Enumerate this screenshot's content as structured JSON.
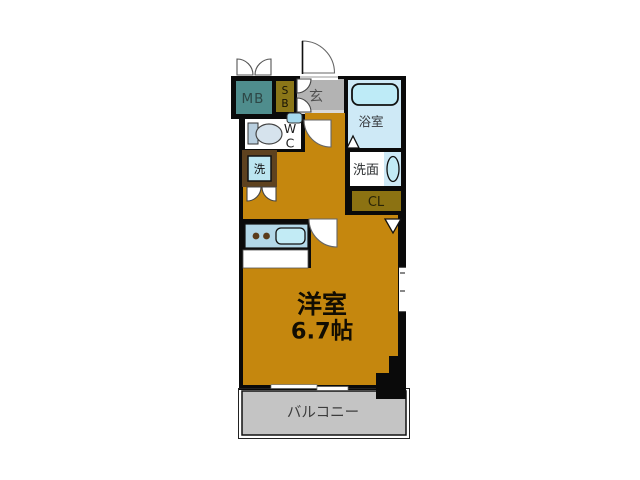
{
  "floorplan": {
    "rooms": {
      "mb": {
        "label": "MB",
        "color": "#4F8D8D",
        "text_color": "#2E4746"
      },
      "sb": {
        "line1": "S",
        "line2": "B",
        "color": "#8B7618",
        "text_color": "#171307"
      },
      "genkan": {
        "label": "玄",
        "color": "#B3B3B3",
        "text_color": "#4F4F4F"
      },
      "bathroom": {
        "label": "浴室",
        "color": "#CEE9F6",
        "text_color": "#36393D"
      },
      "wc": {
        "line1": "W",
        "line2": "C",
        "color": "#FFFFFF",
        "text_color": "#1C1C1C"
      },
      "washer": {
        "label": "洗",
        "color": "#BCE6F0",
        "frame_color": "#5E421F",
        "text_color": "#0D0D0D"
      },
      "washroom": {
        "label": "洗面",
        "color": "#FFFFFF",
        "strip_color": "#CDE9F6",
        "text_color": "#2B2E30"
      },
      "closet": {
        "label": "CL",
        "color": "#8C7212",
        "text_color": "#2A2508"
      },
      "main": {
        "name": "洋室",
        "size": "6.7帖",
        "color": "#C5870E",
        "text_color": "#120D02"
      },
      "balcony": {
        "label": "バルコニー",
        "color": "#C4C4C4",
        "text_color": "#3C3C3C"
      }
    },
    "fixtures": {
      "wall": "#0A0A0A",
      "tub": "#BEEBF7",
      "sink": "#C2EBF5",
      "counter": "#B3D8E8",
      "burner": "#5A3B1B",
      "toilet_bowl": "#D6E3ED",
      "toilet_tank": "#B9CFDF",
      "wc_basin": "#A5DAEE",
      "step": "#D9D9D9"
    }
  }
}
